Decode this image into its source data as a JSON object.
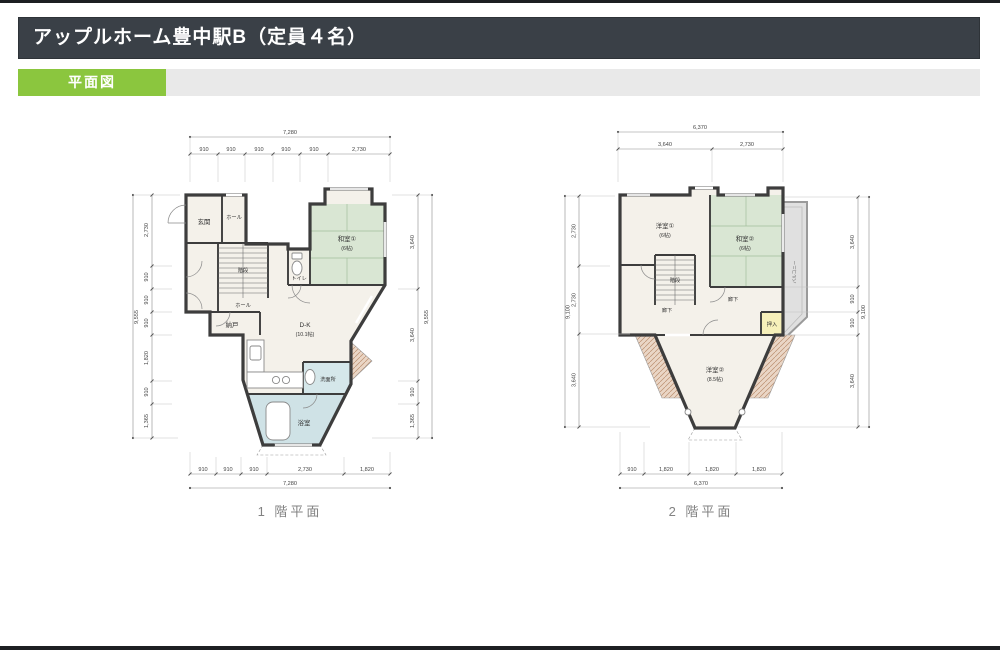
{
  "header": {
    "title": "アップルホーム豊中駅B（定員４名）"
  },
  "tab": {
    "label": "平面図"
  },
  "colors": {
    "header_bg": "#3a4047",
    "tab_green": "#8bc63e",
    "strip_gray": "#e9e9e9",
    "wall": "#3d3d3d",
    "room_beige": "#f4f1ea",
    "tatami_green": "#d9e6d3",
    "bath_blue": "#cfe2e6",
    "closet_yellow": "#f6f0ba",
    "hatch_brown": "#ead6c6",
    "balcony_gray": "#e0e0e0"
  },
  "floor1": {
    "caption": "1 階平面",
    "rooms": {
      "genkan": "玄関",
      "hall_upper": "ホール",
      "stairs": "階段",
      "hall_lower": "ホール",
      "storage": "納戸",
      "toilet": "トイレ",
      "washitsu1_name": "和室①",
      "washitsu1_size": "(6帖)",
      "dk_name": "D-K",
      "dk_size": "(10.1帖)",
      "washroom": "洗面所",
      "bath": "浴室"
    },
    "dims": {
      "top_total": "7,280",
      "top": [
        "910",
        "910",
        "910",
        "910",
        "910",
        "2,730"
      ],
      "left_total": "9,555",
      "left": [
        "2,730",
        "910",
        "910",
        "910",
        "1,820",
        "910",
        "1,365"
      ],
      "right_total": "9,555",
      "right": [
        "3,640",
        "3,640",
        "910",
        "1,365"
      ],
      "bottom_total": "7,280",
      "bottom": [
        "910",
        "910",
        "910",
        "2,730",
        "1,820"
      ]
    }
  },
  "floor2": {
    "caption": "2 階平面",
    "rooms": {
      "yoshitsu1_name": "洋室①",
      "yoshitsu1_size": "(6帖)",
      "washitsu2_name": "和室②",
      "washitsu2_size": "(6帖)",
      "stairs": "階段",
      "corridor1": "廊下",
      "corridor2": "廊下",
      "oshiire": "押入",
      "balcony": "バルコニー",
      "yoshitsu2_name": "洋室②",
      "yoshitsu2_size": "(8.5帖)"
    },
    "dims": {
      "top_total": "6,370",
      "top": [
        "3,640",
        "2,730"
      ],
      "left_total": "9,100",
      "left": [
        "2,730",
        "2,730",
        "3,640"
      ],
      "right_total": "9,100",
      "right": [
        "3,640",
        "910",
        "910",
        "3,640"
      ],
      "bottom_total": "6,370",
      "bottom": [
        "910",
        "1,820",
        "1,820",
        "1,820"
      ]
    }
  }
}
